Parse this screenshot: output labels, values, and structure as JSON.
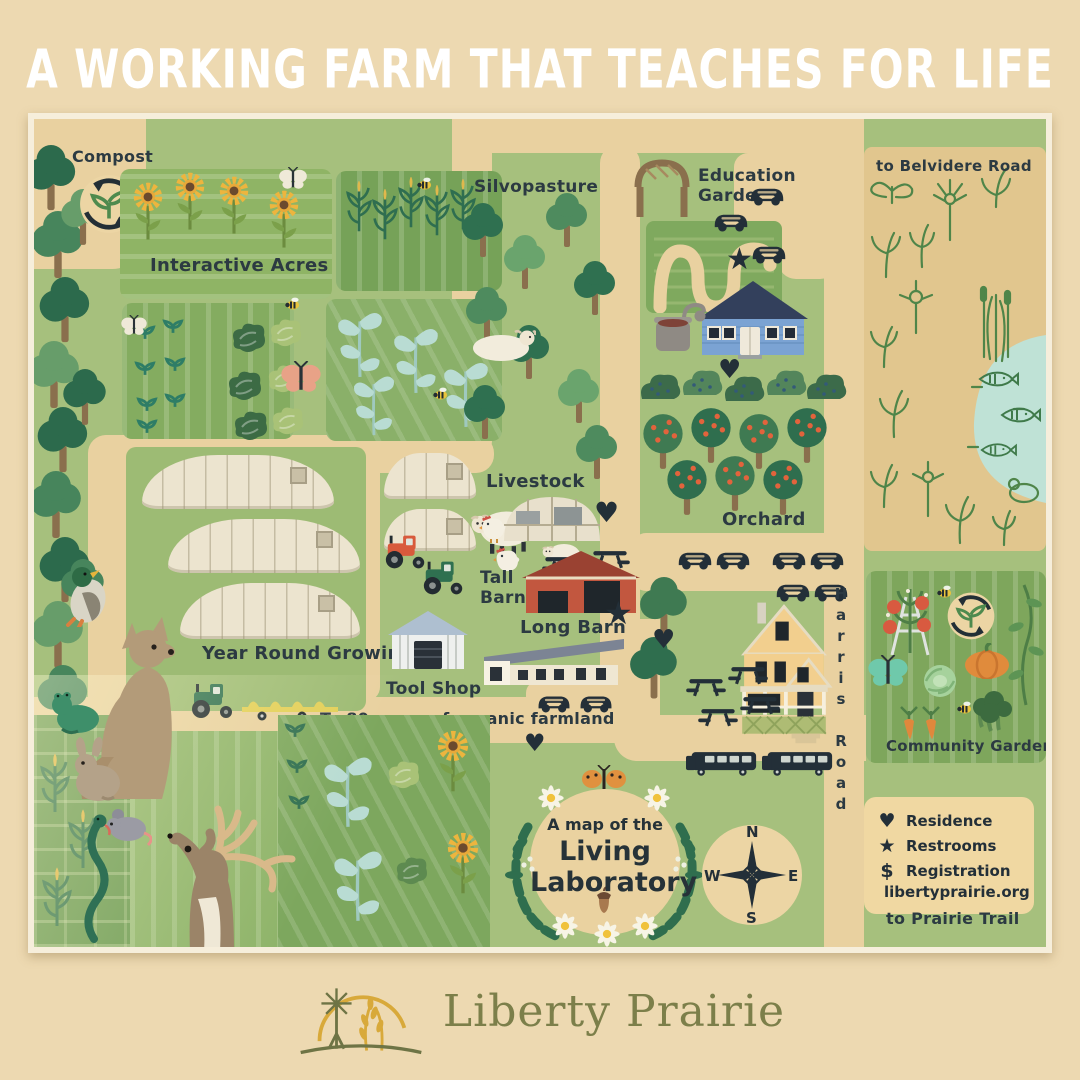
{
  "title": "A WORKING FARM THAT TEACHES FOR LIFE",
  "map": {
    "areas": {
      "compost": "Compost",
      "interactive_acres": "Interactive Acres",
      "silvopasture": "Silvopasture",
      "education_garden_line1": "Education",
      "education_garden_line2": "Garden",
      "to_belvidere_road": "to Belvidere Road",
      "livestock": "Livestock",
      "tall_barn_line1": "Tall",
      "tall_barn_line2": "Barn",
      "long_barn": "Long Barn",
      "year_round_growing": "Year Round Growing",
      "tool_shop": "Tool Shop",
      "organic_farmland": "To 80 acres of organic farmland",
      "orchard": "Orchard",
      "harris_road": "Harris Road",
      "community_garden": "Community Garden",
      "to_prairie_trail": "to Prairie Trail"
    },
    "badge": {
      "line1": "A map of the",
      "line2": "Living",
      "line3": "Laboratory"
    },
    "compass": {
      "north": "N",
      "east": "E",
      "south": "S",
      "west": "W"
    },
    "legend": {
      "heart_symbol": "♥",
      "star_symbol": "★",
      "dollar_symbol": "$",
      "residence": "Residence",
      "restrooms": "Restrooms",
      "registration": "Registration",
      "website": "libertyprairie.org"
    },
    "markers": {
      "heart": "♥",
      "star": "★"
    }
  },
  "footer": {
    "brand": "Liberty Prairie"
  },
  "colors": {
    "page_bg": "#edd9b1",
    "map_green": "#a6c07d",
    "road_tan": "#e9d1a0",
    "ink": "#2c3a42",
    "barn_red": "#c2573f",
    "house_blue": "#7ba3d3",
    "house_yellow": "#f2cf8e",
    "pond_blue": "#bfe2d6",
    "belvidere_panel": "#e1c68e",
    "logo_olive": "#6e7445",
    "logo_gold": "#d8a93a"
  }
}
